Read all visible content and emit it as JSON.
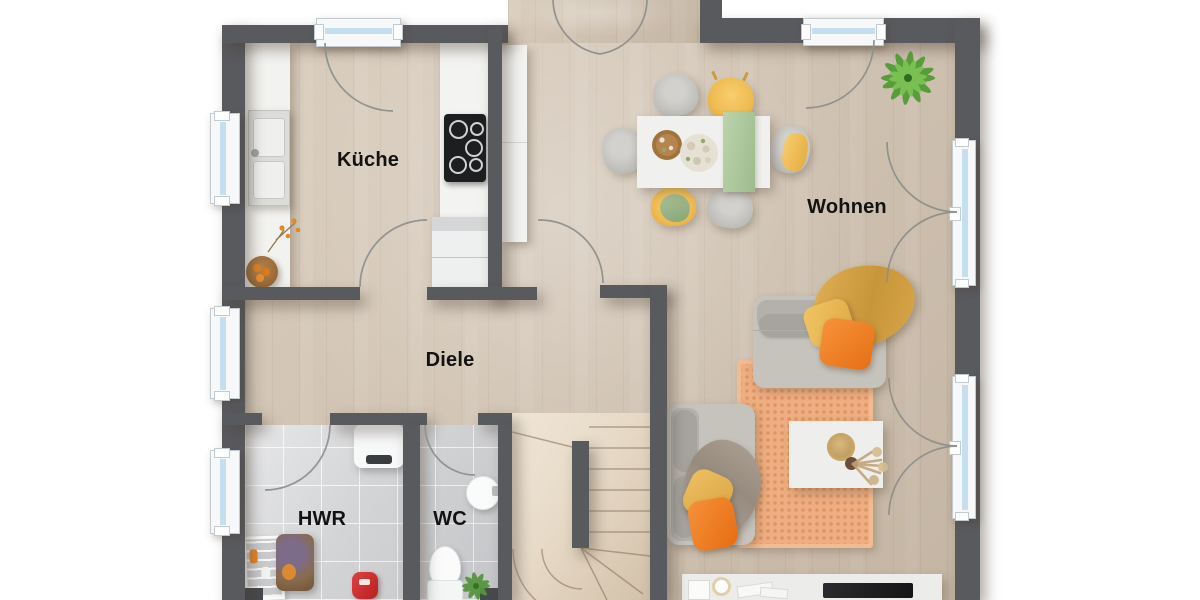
{
  "rooms": {
    "kueche": {
      "label": "Küche"
    },
    "wohnen": {
      "label": "Wohnen"
    },
    "diele": {
      "label": "Diele"
    },
    "hwr": {
      "label": "HWR"
    },
    "wc": {
      "label": "WC"
    }
  },
  "palette": {
    "wall": "#595a5e",
    "wood": "#d5c7b6",
    "tile": "#d3d4d6",
    "stair": "#e8dccb",
    "glass": "#c6dfef",
    "frame": "#f6f8f9",
    "rug": "#efae81",
    "sofa_gray": "#c6c3bd",
    "chair_yellow": "#f0bf56",
    "pillow_orange": "#ee7e22",
    "runner_green": "#b7cfa5",
    "throw_mustard": "#d7a243",
    "plant_green": "#5ea83e",
    "label_color": "#121212"
  }
}
